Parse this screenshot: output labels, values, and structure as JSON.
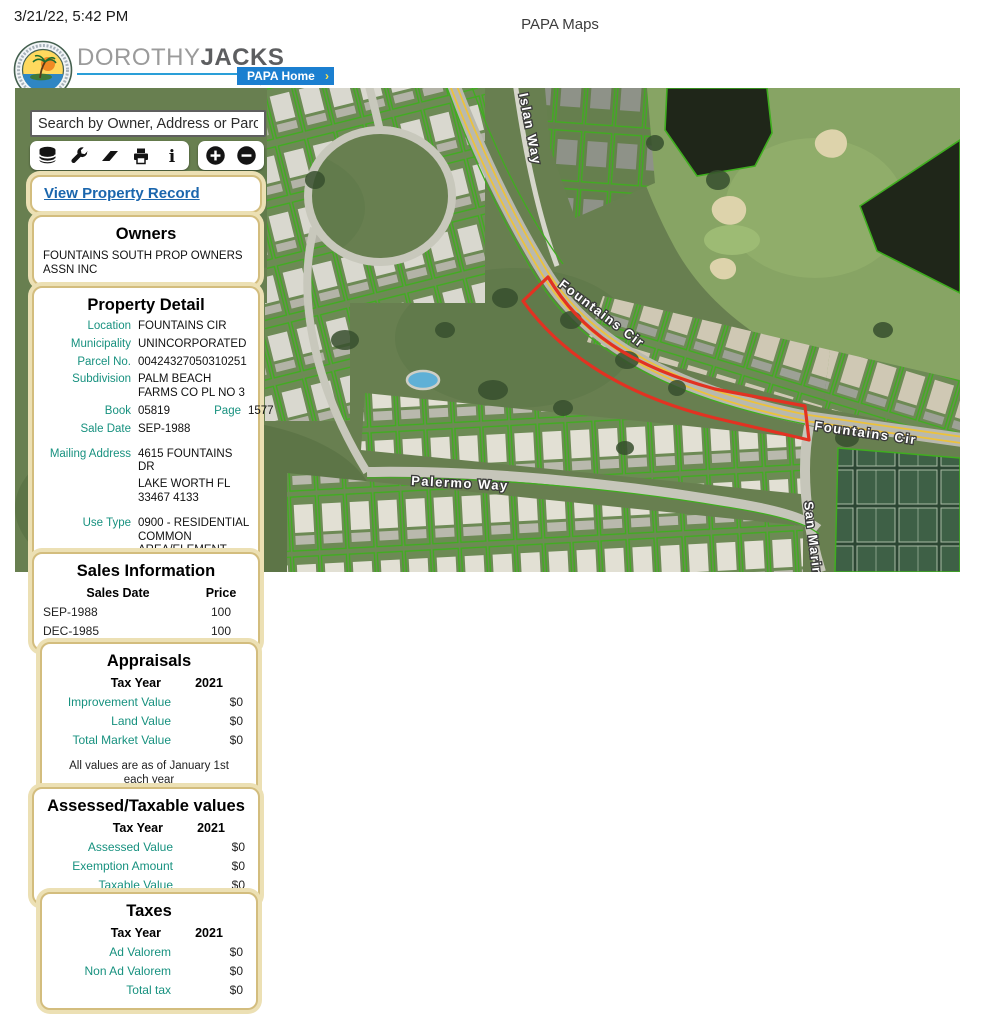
{
  "page": {
    "timestamp": "3/21/22, 5:42 PM",
    "title": "PAPA Maps"
  },
  "header": {
    "brand_first": "DOROTHY",
    "brand_last": "JACKS",
    "credentials": "CFA, AAS",
    "org": "Palm Beach County Property Appraiser",
    "tagline": "We Value What You Value",
    "home_button": "PAPA Home",
    "home_arrow": "›"
  },
  "search": {
    "placeholder": "Search by Owner, Address or Parcel"
  },
  "toolbar": {
    "icons": [
      "layers",
      "tools",
      "eraser",
      "print",
      "info"
    ],
    "zoom_in": "zoom-in",
    "zoom_out": "zoom-out"
  },
  "actions": {
    "view_property_record": "View Property Record"
  },
  "owners": {
    "title": "Owners",
    "name": "FOUNTAINS SOUTH PROP OWNERS ASSN INC"
  },
  "property_detail": {
    "title": "Property Detail",
    "location_label": "Location",
    "location": "FOUNTAINS CIR",
    "municipality_label": "Municipality",
    "municipality": "UNINCORPORATED",
    "parcel_label": "Parcel No.",
    "parcel": "00424327050310251",
    "subdivision_label": "Subdivision",
    "subdivision": "PALM BEACH FARMS CO PL NO 3",
    "book_label": "Book",
    "book": "05819",
    "page_label": "Page",
    "page": "1577",
    "sale_date_label": "Sale Date",
    "sale_date": "SEP-1988",
    "mailing_label": "Mailing Address",
    "mailing_line1": "4615 FOUNTAINS DR",
    "mailing_line2": "LAKE WORTH FL 33467 4133",
    "use_type_label": "Use Type",
    "use_type": "0900 - RESIDENTIAL COMMON AREA/ELEMENT",
    "sqft_label": "Total Square Feet",
    "sqft": "0"
  },
  "sales": {
    "title": "Sales Information",
    "col_date": "Sales Date",
    "col_price": "Price",
    "rows": [
      {
        "date": "SEP-1988",
        "price": "100"
      },
      {
        "date": "DEC-1985",
        "price": "100"
      }
    ]
  },
  "appraisals": {
    "title": "Appraisals",
    "tax_year_label": "Tax Year",
    "tax_year": "2021",
    "rows": [
      {
        "label": "Improvement Value",
        "value": "$0"
      },
      {
        "label": "Land Value",
        "value": "$0"
      },
      {
        "label": "Total Market Value",
        "value": "$0"
      }
    ],
    "note": "All values are as of January 1st each year"
  },
  "assessed": {
    "title": "Assessed/Taxable values",
    "tax_year_label": "Tax Year",
    "tax_year": "2021",
    "rows": [
      {
        "label": "Assessed Value",
        "value": "$0"
      },
      {
        "label": "Exemption Amount",
        "value": "$0"
      },
      {
        "label": "Taxable Value",
        "value": "$0"
      }
    ]
  },
  "taxes": {
    "title": "Taxes",
    "tax_year_label": "Tax Year",
    "tax_year": "2021",
    "rows": [
      {
        "label": "Ad Valorem",
        "value": "$0"
      },
      {
        "label": "Non Ad Valorem",
        "value": "$0"
      },
      {
        "label": "Total tax",
        "value": "$0"
      }
    ]
  },
  "map": {
    "labels": {
      "islan_way": "Islan Way",
      "fountains_cir_1": "Fountains Cir",
      "fountains_cir_2": "Fountains Cir",
      "palermo_way": "Palermo Way",
      "san_marino": "San Marino"
    }
  },
  "colors": {
    "teal_label": "#17917f",
    "panel_border": "#d3bd7e",
    "panel_halo": "#ece0b4",
    "link_blue": "#1b66ad",
    "brand_blue": "#2a9fd8",
    "home_button_blue": "#1b7fd0",
    "parcel_green": "#3fae1f",
    "selection_red": "#e23222"
  }
}
